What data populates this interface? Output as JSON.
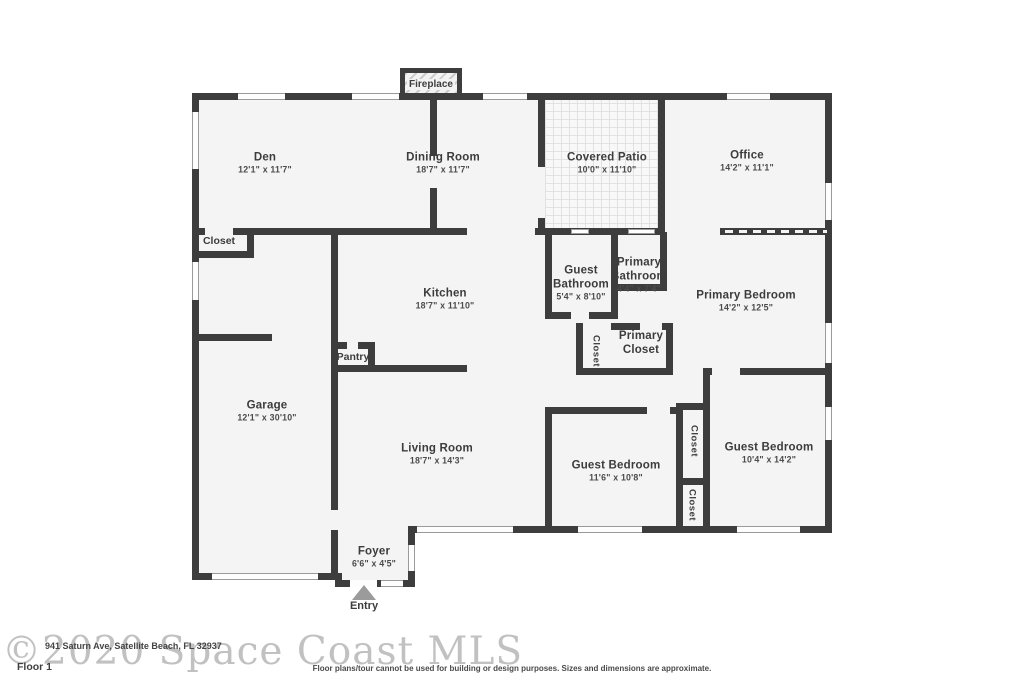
{
  "plan": {
    "rooms": [
      {
        "name": "Den",
        "dims": "12'1\" x 11'7\""
      },
      {
        "name": "Dining Room",
        "dims": "18'7\" x 11'7\""
      },
      {
        "name": "Covered Patio",
        "dims": "10'0\" x 11'10\""
      },
      {
        "name": "Office",
        "dims": "14'2\" x 11'1\""
      },
      {
        "name": "Kitchen",
        "dims": "18'7\" x 11'10\""
      },
      {
        "name": "Guest Bathroom",
        "dims": "5'4\" x 8'10\""
      },
      {
        "name": "Primary Bathroom",
        "dims": "4'4\" x 7'4\""
      },
      {
        "name": "Primary Bedroom",
        "dims": "14'2\" x 12'5\""
      },
      {
        "name": "Primary Closet",
        "dims": ""
      },
      {
        "name": "Garage",
        "dims": "12'1\" x 30'10\""
      },
      {
        "name": "Living Room",
        "dims": "18'7\" x 14'3\""
      },
      {
        "name": "Guest Bedroom",
        "dims": "11'6\" x 10'8\""
      },
      {
        "name": "Guest Bedroom",
        "dims": "10'4\" x 14'2\""
      },
      {
        "name": "Foyer",
        "dims": "6'6\" x 4'5\""
      }
    ],
    "features": {
      "fireplace": "Fireplace",
      "closet": "Closet",
      "pantry": "Pantry",
      "entry": "Entry"
    },
    "footer": {
      "watermark": "©2020 Space Coast MLS",
      "address": "941 Saturn Ave, Satellite Beach, FL 32937",
      "floor": "Floor 1",
      "disclaimer": "Floor plans/tour cannot be used for building or design purposes. Sizes and dimensions are approximate."
    },
    "colors": {
      "wall": "#3d3d3d",
      "room_fill": "#f4f4f4",
      "window": "#fdfdfd",
      "entry_arrow": "#9b9b9b",
      "watermark": "#8f8f8f"
    }
  }
}
